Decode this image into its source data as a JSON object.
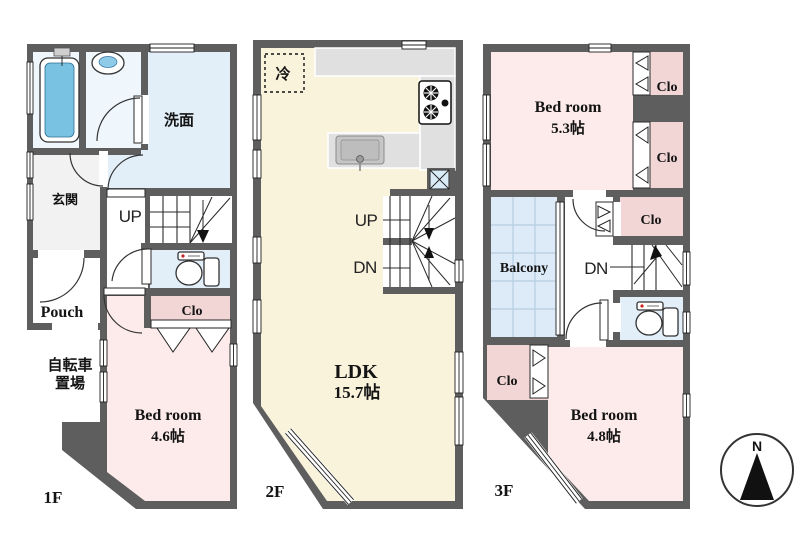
{
  "colors": {
    "wall": "#5e5e5e",
    "bedroom_pink": "#fcebea",
    "closet_pink": "#f2d6d6",
    "water_blue": "#e2eef8",
    "bath_blue": "#eff7fc",
    "balcony_blue": "#dcebf7",
    "ldk_cream": "#faf3dc",
    "entrance_gray": "#f2f2f2",
    "tub_blue": "#79c2e2",
    "counter_gray": "#e0e0e0",
    "shaft_blue": "#d9ebf7"
  },
  "floor1": {
    "label": "1F",
    "washroom": "洗面",
    "entrance": "玄関",
    "stairs_up": "UP",
    "porch": "Pouch",
    "bicycle_line1": "自転車",
    "bicycle_line2": "置場",
    "closet": "Clo",
    "bedroom_name": "Bed room",
    "bedroom_size": "4.6帖"
  },
  "floor2": {
    "label": "2F",
    "refrigerator": "冷",
    "stairs_up": "UP",
    "stairs_down": "DN",
    "ldk_name": "LDK",
    "ldk_size": "15.7帖"
  },
  "floor3": {
    "label": "3F",
    "bedroom1_name": "Bed room",
    "bedroom1_size": "5.3帖",
    "closet1": "Clo",
    "closet2": "Clo",
    "closet3": "Clo",
    "closet4": "Clo",
    "balcony": "Balcony",
    "stairs_down": "DN",
    "bedroom2_name": "Bed room",
    "bedroom2_size": "4.8帖"
  },
  "compass": {
    "north": "N"
  }
}
